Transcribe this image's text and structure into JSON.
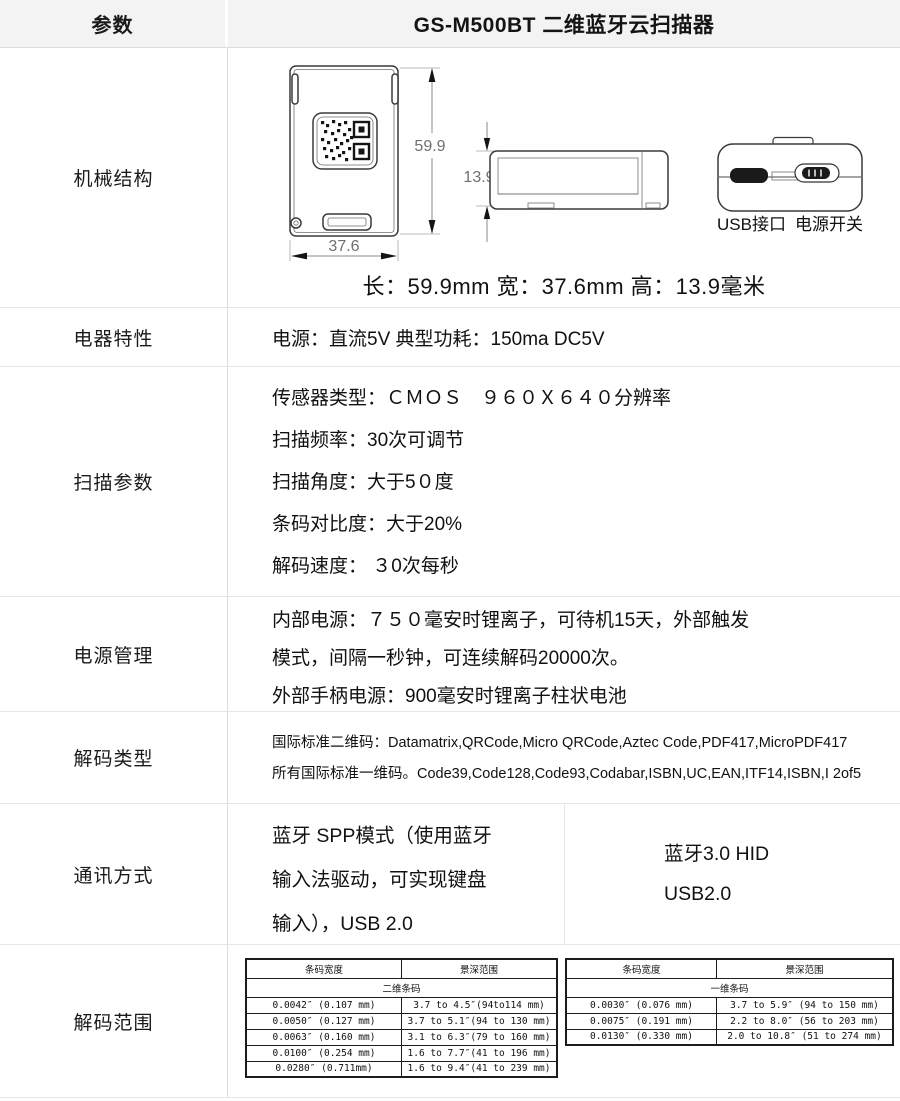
{
  "header": {
    "param_label": "参数",
    "title": "GS-M500BT 二维蓝牙云扫描器"
  },
  "mechanical": {
    "label": "机械结构",
    "dim_height": "59.9",
    "dim_width": "37.6",
    "dim_thickness": "13.9",
    "usb_label": "USB接口",
    "switch_label": "电源开关",
    "summary": "长：59.9mm  宽：37.6mm  高：13.9毫米"
  },
  "electrical": {
    "label": "电器特性",
    "text": "电源：直流5V  典型功耗：150ma DC5V"
  },
  "scanning": {
    "label": "扫描参数",
    "lines": [
      "传感器类型：ＣＭＯＳ　９６０Ｘ６４０分辨率",
      "扫描频率：30次可调节",
      "扫描角度：大于5０度",
      "条码对比度：大于20%",
      "解码速度： ３0次每秒"
    ]
  },
  "power": {
    "label": "电源管理",
    "lines": [
      "内部电源：７５０毫安时锂离子，可待机15天，外部触发",
      "模式，间隔一秒钟，可连续解码20000次。",
      "外部手柄电源：900毫安时锂离子柱状电池"
    ]
  },
  "decode_types": {
    "label": "解码类型",
    "lines": [
      "国际标准二维码：Datamatrix,QRCode,Micro QRCode,Aztec Code,PDF417,MicroPDF417",
      "所有国际标准一维码。Code39,Code128,Code93,Codabar,ISBN,UC,EAN,ITF14,ISBN,I 2of5"
    ]
  },
  "communication": {
    "label": "通讯方式",
    "left_lines": [
      "蓝牙 SPP模式（使用蓝牙",
      "输入法驱动，可实现键盘",
      "输入），USB 2.0"
    ],
    "right_lines": [
      "蓝牙3.0 HID",
      "USB2.0"
    ]
  },
  "decode_range": {
    "label": "解码范围",
    "col_width_label": "条码宽度",
    "col_range_label": "景深范围",
    "table_2d": {
      "span": "二维条码",
      "rows": [
        [
          "0.0042″ (0.107 mm)",
          "3.7 to 4.5″(94to114 mm)"
        ],
        [
          "0.0050″ (0.127 mm)",
          "3.7 to 5.1″(94 to 130 mm)"
        ],
        [
          "0.0063″ (0.160 mm)",
          "3.1 to 6.3″(79 to 160 mm)"
        ],
        [
          "0.0100″ (0.254 mm)",
          "1.6 to 7.7″(41 to 196 mm)"
        ],
        [
          "0.0280″  (0.711mm)",
          "1.6 to 9.4″(41 to 239 mm)"
        ]
      ]
    },
    "table_1d": {
      "span": "一维条码",
      "rows": [
        [
          "0.0030″ (0.076 mm)",
          "3.7 to 5.9″ (94 to 150 mm)"
        ],
        [
          "0.0075″ (0.191 mm)",
          "2.2 to 8.0″ (56 to 203 mm)"
        ],
        [
          "0.0130″ (0.330 mm)",
          "2.0 to 10.8″ (51 to 274 mm)"
        ]
      ]
    }
  }
}
